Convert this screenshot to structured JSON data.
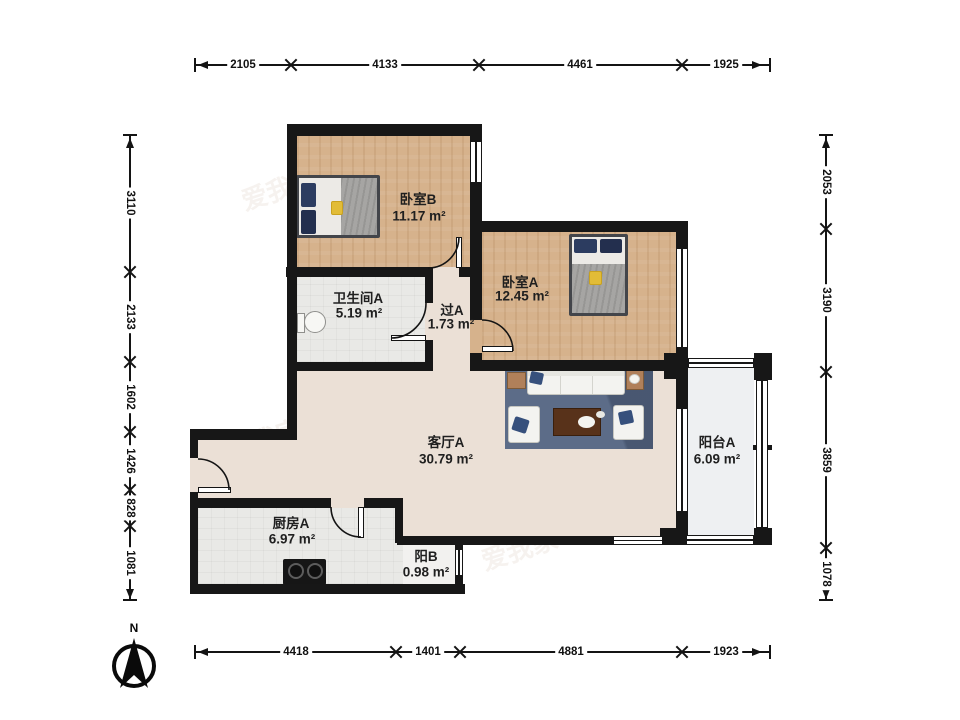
{
  "rooms": {
    "bedroom_b": {
      "name": "卧室B",
      "area": "11.17 m²"
    },
    "bedroom_a": {
      "name": "卧室A",
      "area": "12.45 m²"
    },
    "bathroom_a": {
      "name": "卫生间A",
      "area": "5.19 m²"
    },
    "hallway_a": {
      "name": "过A",
      "area": "1.73 m²"
    },
    "living_a": {
      "name": "客厅A",
      "area": "30.79 m²"
    },
    "balcony_a": {
      "name": "阳台A",
      "area": "6.09 m²"
    },
    "kitchen_a": {
      "name": "厨房A",
      "area": "6.97 m²"
    },
    "balcony_b": {
      "name": "阳B",
      "area": "0.98 m²"
    }
  },
  "dimensions": {
    "top": [
      "2105",
      "4133",
      "4461",
      "1925"
    ],
    "bottom": [
      "4418",
      "1401",
      "4881",
      "1923"
    ],
    "left": [
      "3110",
      "2133",
      "1602",
      "1426",
      "828",
      "1081"
    ],
    "right": [
      "2053",
      "3190",
      "3859",
      "1078"
    ]
  },
  "compass": {
    "label": "N"
  },
  "watermark": {
    "text": "爱我家"
  },
  "colors": {
    "wall": "#171717",
    "wood_floor": "#d6b28c",
    "living_floor": "#ebe0d6",
    "tile_floor": "#e9e9e6",
    "balcony_floor": "#eef0f2",
    "rug": "#5c6c88",
    "sofa": "#f3f3f0",
    "coffee_table": "#58321a",
    "side_table": "#b0805a",
    "pillow_navy": "#2c3c60",
    "accent_yellow": "#e2bc37"
  }
}
